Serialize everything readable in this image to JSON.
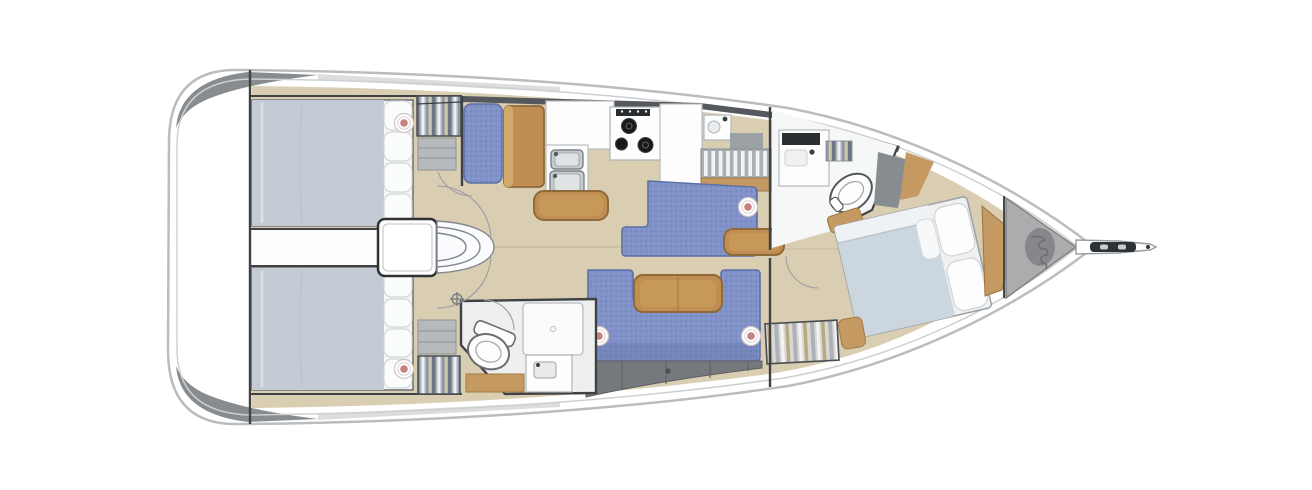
{
  "image": {
    "title": "Sailing yacht interior layout — top-down floor plan",
    "kind": "boat-floorplan-illustration",
    "orientation": {
      "bow": "right",
      "stern": "left",
      "top_side": "port",
      "bottom_side": "starboard"
    }
  },
  "colors": {
    "background": "#ffffff",
    "hull_outline": "#b9bdc0",
    "hull_inner_line": "#cdd0d2",
    "deck_shade_dark": "#898c8f",
    "deck_shade_light": "#c7cbce",
    "floor_wood": "#d9cdb2",
    "floor_seam": "#c6b99d",
    "wall_dark": "#3f4245",
    "wall_medium": "#55595d",
    "upholstery_blue": "#8092c8",
    "upholstery_blue_dark": "#5e6fa6",
    "wood_furniture": "#c08e52",
    "wood_furniture_dark": "#8f6a38",
    "wood_light": "#c49a62",
    "bed_duvet": "#c3ccd4",
    "fwd_bed_duvet": "#ccd6de",
    "linen_white": "#fbfcfc",
    "locker_gray": "#75797c",
    "anchor_locker_gray": "#aaacae",
    "chain_gray": "#85878a",
    "partition_gray": "#878c90",
    "stainless": "#c6cbcf",
    "burner_black": "#17191b",
    "pillow_accent_pink": "#c8827e"
  },
  "areas": {
    "transom_platform": {
      "label": "Stern swim platform"
    },
    "port_aft_cabin": {
      "label": "Port aft cabin",
      "furniture": [
        "double berth",
        "stacked pillows",
        "accent pillow",
        "hanging locker",
        "shelf unit"
      ]
    },
    "starboard_aft_cabin": {
      "label": "Starboard aft cabin",
      "furniture": [
        "double berth",
        "stacked pillows",
        "accent pillow",
        "hanging locker",
        "shelf unit"
      ]
    },
    "engine_compartment": {
      "label": "Engine compartment between aft cabins"
    },
    "companionway": {
      "label": "Companionway steps",
      "step_count": 3
    },
    "nav_station": {
      "label": "Navigation station",
      "furniture": [
        "blue seat",
        "chart table"
      ]
    },
    "galley": {
      "label": "Galley",
      "features": [
        "double stainless sink",
        "three-burner stove",
        "white counters",
        "dish rack",
        "small basin",
        "wood trim"
      ]
    },
    "salon": {
      "label": "Salon",
      "features": [
        "port L-settee",
        "wood ottoman",
        "island table",
        "U-shaped starboard settee",
        "dining table",
        "under-seat lockers"
      ]
    },
    "aft_head": {
      "label": "Starboard aft head",
      "features": [
        "toilet",
        "shower pan",
        "washbasin cabinet",
        "wood grating"
      ]
    },
    "forward_head": {
      "label": "Forward en-suite head",
      "features": [
        "vanity washbasin",
        "toilet",
        "gray partition",
        "wood trim"
      ]
    },
    "forward_cabin": {
      "label": "Forward owner's cabin",
      "furniture": [
        "angled island double berth",
        "white pillows",
        "wood headboard wedge",
        "striped locker bench",
        "wood seat"
      ]
    },
    "anchor_locker": {
      "label": "Anchor locker",
      "contents": [
        "chain pile"
      ]
    },
    "bowsprit": {
      "label": "Bowsprit with anchor roller"
    }
  },
  "counts": {
    "cabins": 3,
    "heads": 2,
    "accent_pillows": 5,
    "companionway_steps": 3,
    "stove_burners": 3,
    "aft_berth_pillows_each": 4
  }
}
